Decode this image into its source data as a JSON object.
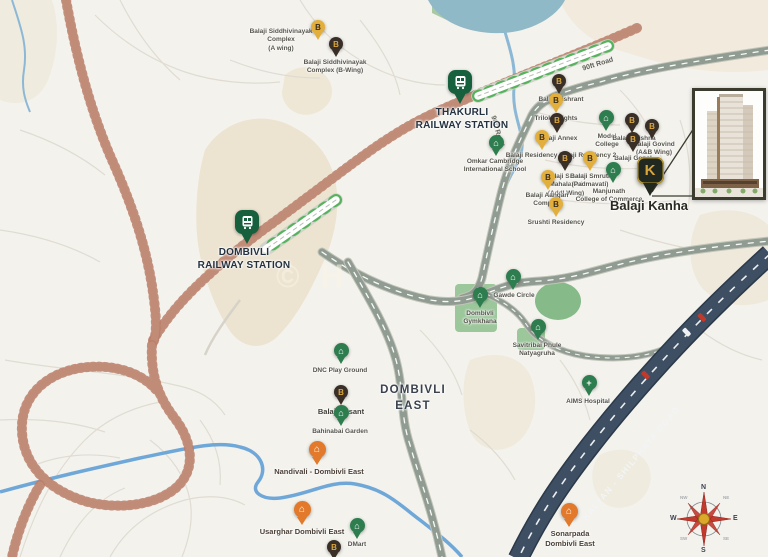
{
  "watermark": "© H",
  "road_labels": {
    "ninety_ft_upper": "90ft Road",
    "ninety_ft_lower": "90ft Road",
    "kalyan": "KALYAN - SHILPHATA ROAD"
  },
  "compass": {
    "north": "N",
    "south": "S",
    "east": "E",
    "west": "W",
    "northeast": "NE",
    "northwest": "NW",
    "southeast": "SE",
    "southwest": "SW"
  },
  "pins": [
    {
      "id": "siddhivinayak-a",
      "label": "Balaji Siddhivinayak\nComplex\n(A wing)",
      "type": "byellow",
      "icon": "b-monogram-icon",
      "x": 318,
      "y": 40,
      "lx": 281,
      "ly": 28
    },
    {
      "id": "siddhivinayak-b",
      "label": "Balaji Siddhivinayak\nComplex (B-Wing)",
      "type": "bdark",
      "icon": "b-monogram-icon",
      "x": 336,
      "y": 57,
      "lx": 335,
      "ly": 59
    },
    {
      "id": "thakurli-station",
      "label": "THAKURLI\nRAILWAY STATION",
      "type": "station",
      "icon": "train-icon",
      "x": 460,
      "y": 104,
      "lx": 462,
      "ly": 107,
      "ls": "station"
    },
    {
      "id": "dombivli-station",
      "label": "DOMBIVLI\nRAILWAY STATION",
      "type": "station",
      "icon": "train-icon",
      "x": 247,
      "y": 244,
      "lx": 244,
      "ly": 247,
      "ls": "station"
    },
    {
      "id": "balaji-vishrant",
      "label": "Balaji Vishrant",
      "type": "bdark",
      "icon": "b-monogram-icon",
      "x": 559,
      "y": 94,
      "lx": 561,
      "ly": 96
    },
    {
      "id": "trilok-heights",
      "label": "Trilok Heights",
      "type": "byellow",
      "icon": "b-monogram-icon",
      "x": 556,
      "y": 113,
      "lx": 556,
      "ly": 115
    },
    {
      "id": "balaji-annex",
      "label": "Balaji Annex",
      "type": "bdark",
      "icon": "b-monogram-icon",
      "x": 557,
      "y": 133,
      "lx": 558,
      "ly": 135
    },
    {
      "id": "model-college",
      "label": "Model\nCollege",
      "type": "landmark",
      "icon": "home-icon",
      "x": 606,
      "y": 131,
      "lx": 607,
      "ly": 133
    },
    {
      "id": "balaji-krishna",
      "label": "Balaji Krishna",
      "type": "bdark",
      "icon": "b-monogram-icon",
      "x": 632,
      "y": 133,
      "lx": 634,
      "ly": 135
    },
    {
      "id": "balaji-govind",
      "label": "Balaji Govind\n(A&B Wing)",
      "type": "bdark",
      "icon": "b-monogram-icon",
      "x": 652,
      "y": 139,
      "lx": 654,
      "ly": 141
    },
    {
      "id": "balaji-gopal",
      "label": "Balaji Gopal",
      "type": "bdark",
      "icon": "b-monogram-icon",
      "x": 633,
      "y": 152,
      "lx": 633,
      "ly": 155
    },
    {
      "id": "omkar-cambridge-school",
      "label": "Omkar Cambridge\nInternational School",
      "type": "landmark",
      "icon": "home-icon",
      "x": 496,
      "y": 156,
      "lx": 495,
      "ly": 158
    },
    {
      "id": "balaji-residency",
      "label": "Balaji Residency Balaji Residency 2",
      "type": "byellow",
      "icon": "b-monogram-icon",
      "x": 542,
      "y": 150,
      "lx": 561,
      "ly": 152
    },
    {
      "id": "balaji-smruti-mahalaxmi",
      "label": "Balaji Smruti\nMahalaxmi\n(Addl Wing)",
      "type": "bdark",
      "icon": "b-monogram-icon",
      "x": 565,
      "y": 171,
      "lx": 566,
      "ly": 173
    },
    {
      "id": "balaji-smruti-padmavati",
      "label": "Balaji Smruti\n(Padmavati)",
      "type": "byellow",
      "icon": "b-monogram-icon",
      "x": 590,
      "y": 171,
      "lx": 590,
      "ly": 173
    },
    {
      "id": "balaji-aangan",
      "label": "Balaji Aangan\nComplex",
      "type": "byellow",
      "icon": "b-monogram-icon",
      "x": 548,
      "y": 190,
      "lx": 547,
      "ly": 192
    },
    {
      "id": "srushti-residency",
      "label": "Srushti Residency",
      "type": "byellow",
      "icon": "b-monogram-icon",
      "x": 556,
      "y": 217,
      "lx": 556,
      "ly": 219
    },
    {
      "id": "manjunath-college",
      "label": "Manjunath\nCollege of Commerce",
      "type": "landmark",
      "icon": "home-icon",
      "x": 613,
      "y": 183,
      "lx": 609,
      "ly": 188
    },
    {
      "id": "balaji-kanha",
      "label": "Balaji Kanha",
      "type": "main",
      "icon": "k-monogram-icon",
      "x": 650,
      "y": 196,
      "lx": 649,
      "ly": 198,
      "ls": "main"
    },
    {
      "id": "gawde-circle",
      "label": "Gawde Circle",
      "type": "landmark",
      "icon": "home-icon",
      "x": 513,
      "y": 290,
      "lx": 514,
      "ly": 292
    },
    {
      "id": "dombivli-gymkhana",
      "label": "Dombivli\nGymkhana",
      "type": "landmark",
      "icon": "home-icon",
      "x": 480,
      "y": 308,
      "lx": 480,
      "ly": 310
    },
    {
      "id": "savitribai-natyagruha",
      "label": "Savitribai Phule\nNatyagruha",
      "type": "landmark",
      "icon": "home-icon",
      "x": 538,
      "y": 340,
      "lx": 537,
      "ly": 342
    },
    {
      "id": "aims-hospital",
      "label": "AIMS Hospital",
      "type": "landmark",
      "icon": "cross-icon",
      "x": 589,
      "y": 396,
      "lx": 588,
      "ly": 398
    },
    {
      "id": "dnc-playground",
      "label": "DNC Play Ground",
      "type": "landmark",
      "icon": "home-icon",
      "x": 341,
      "y": 364,
      "lx": 340,
      "ly": 367
    },
    {
      "id": "balaji-vasant",
      "label": "Balaji Vasant",
      "type": "bdark",
      "icon": "b-monogram-icon",
      "x": 341,
      "y": 405,
      "lx": 341,
      "ly": 407,
      "ls": "med"
    },
    {
      "id": "bahinabai-garden",
      "label": "Bahinabai Garden",
      "type": "landmark",
      "icon": "home-icon",
      "x": 341,
      "y": 426,
      "lx": 340,
      "ly": 428
    },
    {
      "id": "nandivali",
      "label": "Nandivali - Dombivli East",
      "type": "orange",
      "icon": "home-icon",
      "x": 317,
      "y": 465,
      "lx": 319,
      "ly": 467,
      "ls": "locality"
    },
    {
      "id": "dombivli-east-area",
      "label": "DOMBIVLI\nEAST",
      "type": "area",
      "lx": 413,
      "ly": 383,
      "ls": "area"
    },
    {
      "id": "usarghar",
      "label": "Usarghar Dombivli East",
      "type": "orange",
      "icon": "home-icon",
      "x": 302,
      "y": 525,
      "lx": 302,
      "ly": 527,
      "ls": "locality"
    },
    {
      "id": "dmart",
      "label": "DMart",
      "type": "landmark",
      "icon": "home-icon",
      "x": 357,
      "y": 539,
      "lx": 357,
      "ly": 541
    },
    {
      "id": "unlabeled-balaji",
      "label": "",
      "type": "bdark",
      "icon": "b-monogram-icon",
      "x": 334,
      "y": 560,
      "lx": 334,
      "ly": 560
    },
    {
      "id": "sonarpada",
      "label": "Sonarpada\nDombivli East",
      "type": "orange",
      "icon": "home-icon",
      "x": 569,
      "y": 527,
      "lx": 570,
      "ly": 529,
      "ls": "locality"
    }
  ]
}
